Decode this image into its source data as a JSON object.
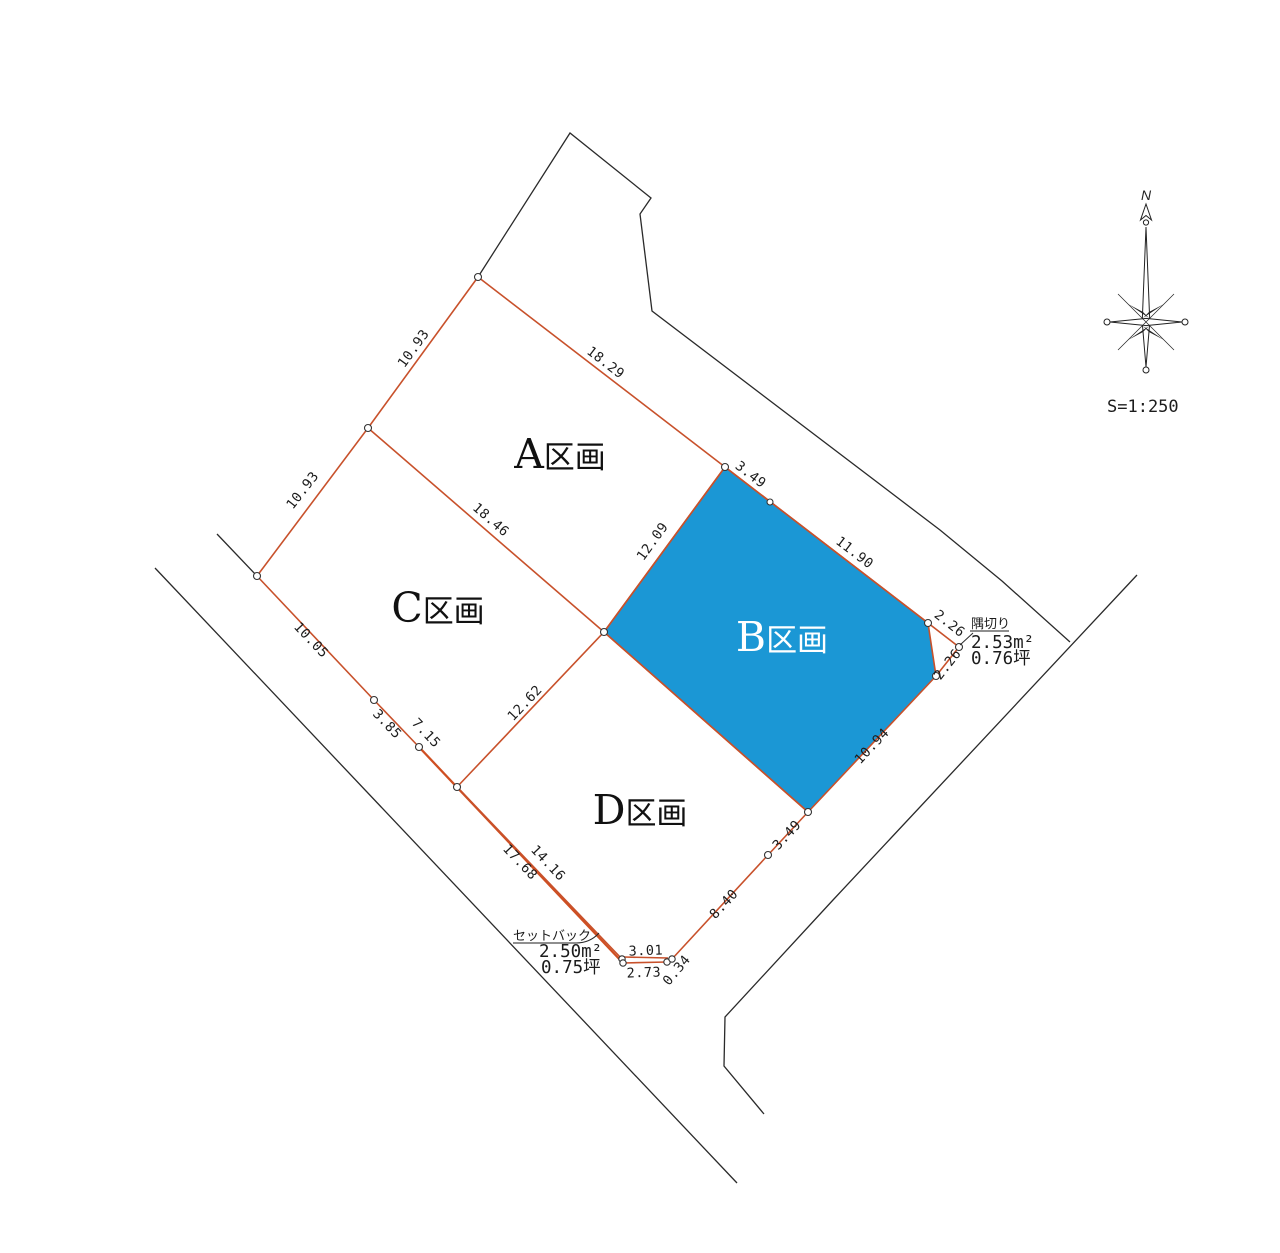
{
  "drawing": {
    "scale_text": "S=1:250",
    "north_label": "N",
    "plots": {
      "a": {
        "letter": "A",
        "suffix": "区画"
      },
      "b": {
        "letter": "B",
        "suffix": "区画",
        "highlight_color": "#1b97d5"
      },
      "c": {
        "letter": "C",
        "suffix": "区画"
      },
      "d": {
        "letter": "D",
        "suffix": "区画"
      }
    },
    "dimensions": {
      "a_left": "10.93",
      "c_left": "10.93",
      "a_top": "18.29",
      "a_bottom": "18.46",
      "a_right": "12.09",
      "b_top_short": "3.49",
      "b_top_long": "11.90",
      "cut_upper": "2.26",
      "cut_lower": "2.26",
      "b_bottom": "10.94",
      "d_se": "3.49",
      "d_s": "8.40",
      "d_left": "12.62",
      "c_sw": "10.05",
      "sw_385": "3.85",
      "sw_715": "7.15",
      "setback_outer": "17.68",
      "setback_inner": "14.16",
      "bottom_301": "3.01",
      "bottom_273": "2.73",
      "bottom_034": "0.34"
    },
    "annotations": {
      "sumikiri": {
        "title": "隅切り",
        "area_m2": "2.53m²",
        "area_tsubo": "0.76坪"
      },
      "setback": {
        "title": "セットバック",
        "area_m2": "2.50m²",
        "area_tsubo": "0.75坪"
      }
    },
    "colors": {
      "parcel_line": "#c8512b",
      "highlight_fill": "#1b97d5",
      "boundary_line": "#2a2a2a"
    }
  }
}
